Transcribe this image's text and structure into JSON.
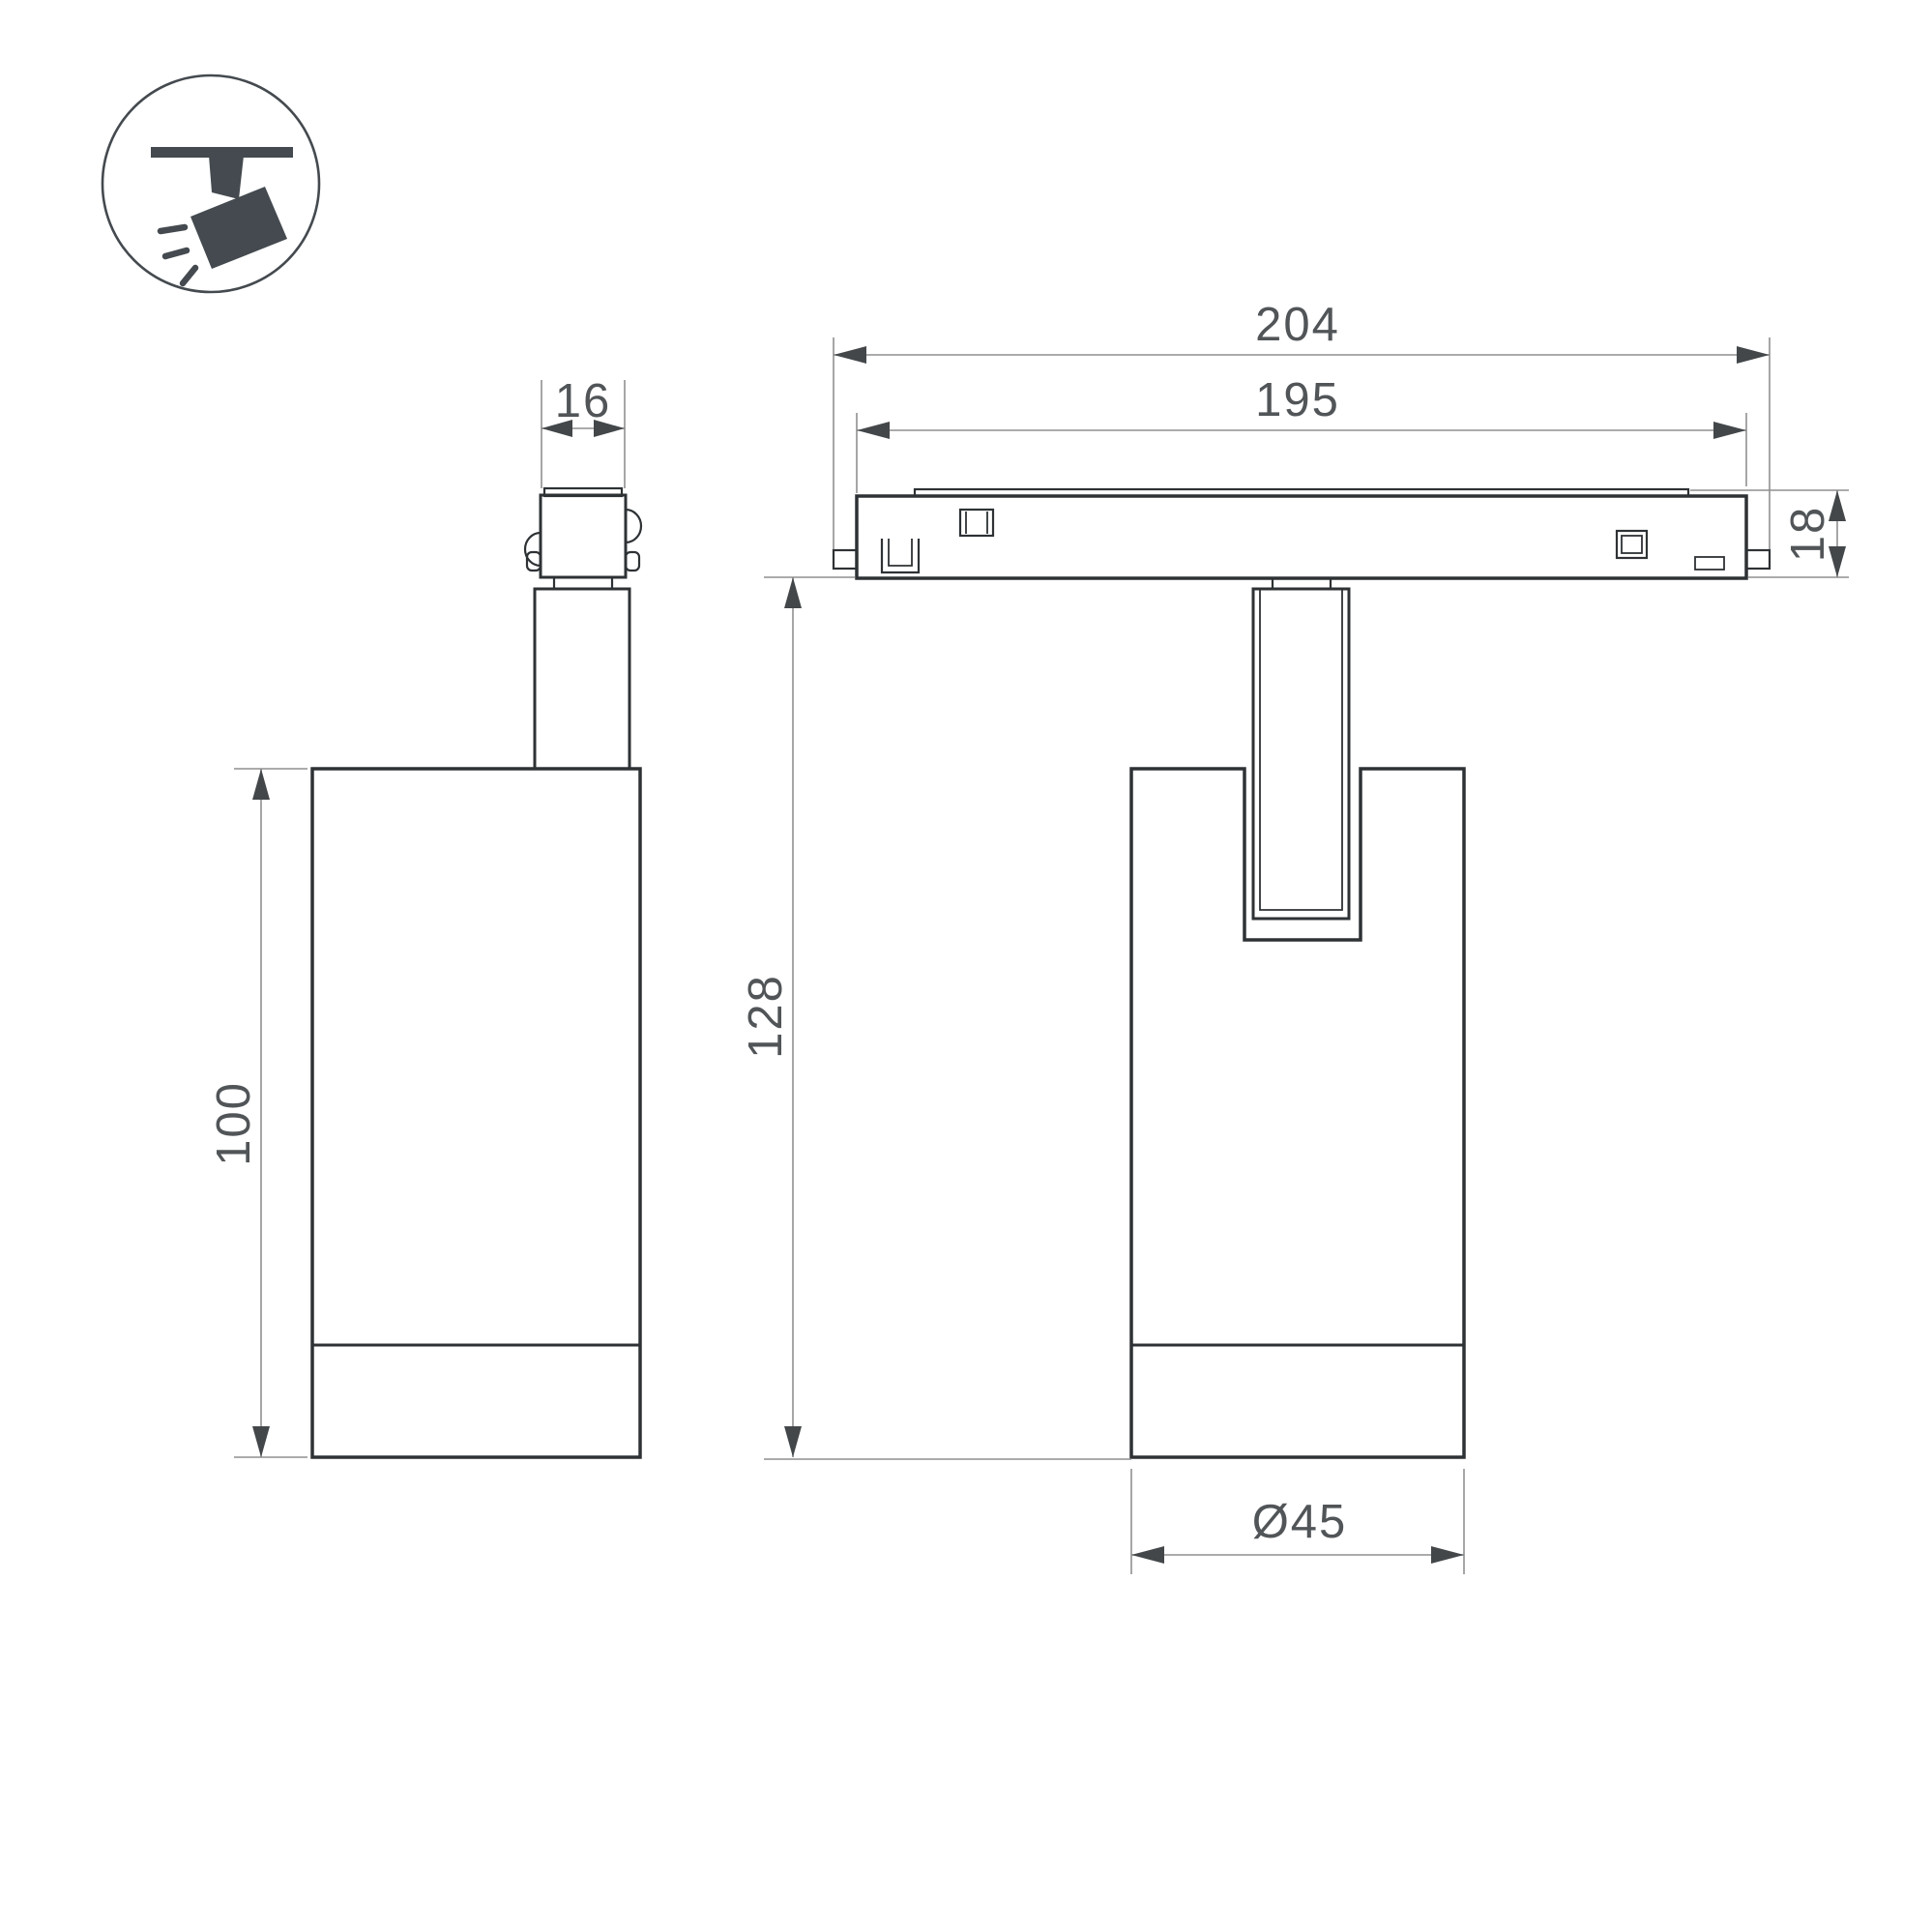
{
  "drawing": {
    "type": "technical-dimension-drawing",
    "subject": "magnetic-track-spotlight",
    "views": {
      "side_view": "spotlight side view with track adapter stem",
      "front_view": "spotlight front view mounted on track profile"
    }
  },
  "dimensions": {
    "adapter_width": "16",
    "track_length_outer": "204",
    "track_length_inner": "195",
    "track_height": "18",
    "body_height": "100",
    "overall_height": "128",
    "body_diameter": "Ø45"
  },
  "icon": {
    "meaning": "ceiling track with tilted spotlight emitting light"
  },
  "colors": {
    "outline": "#2e3235",
    "dimension_line": "#8f8f8f",
    "arrow": "#43474a",
    "text": "#515558",
    "icon": "#444a4f",
    "background": "#ffffff"
  }
}
